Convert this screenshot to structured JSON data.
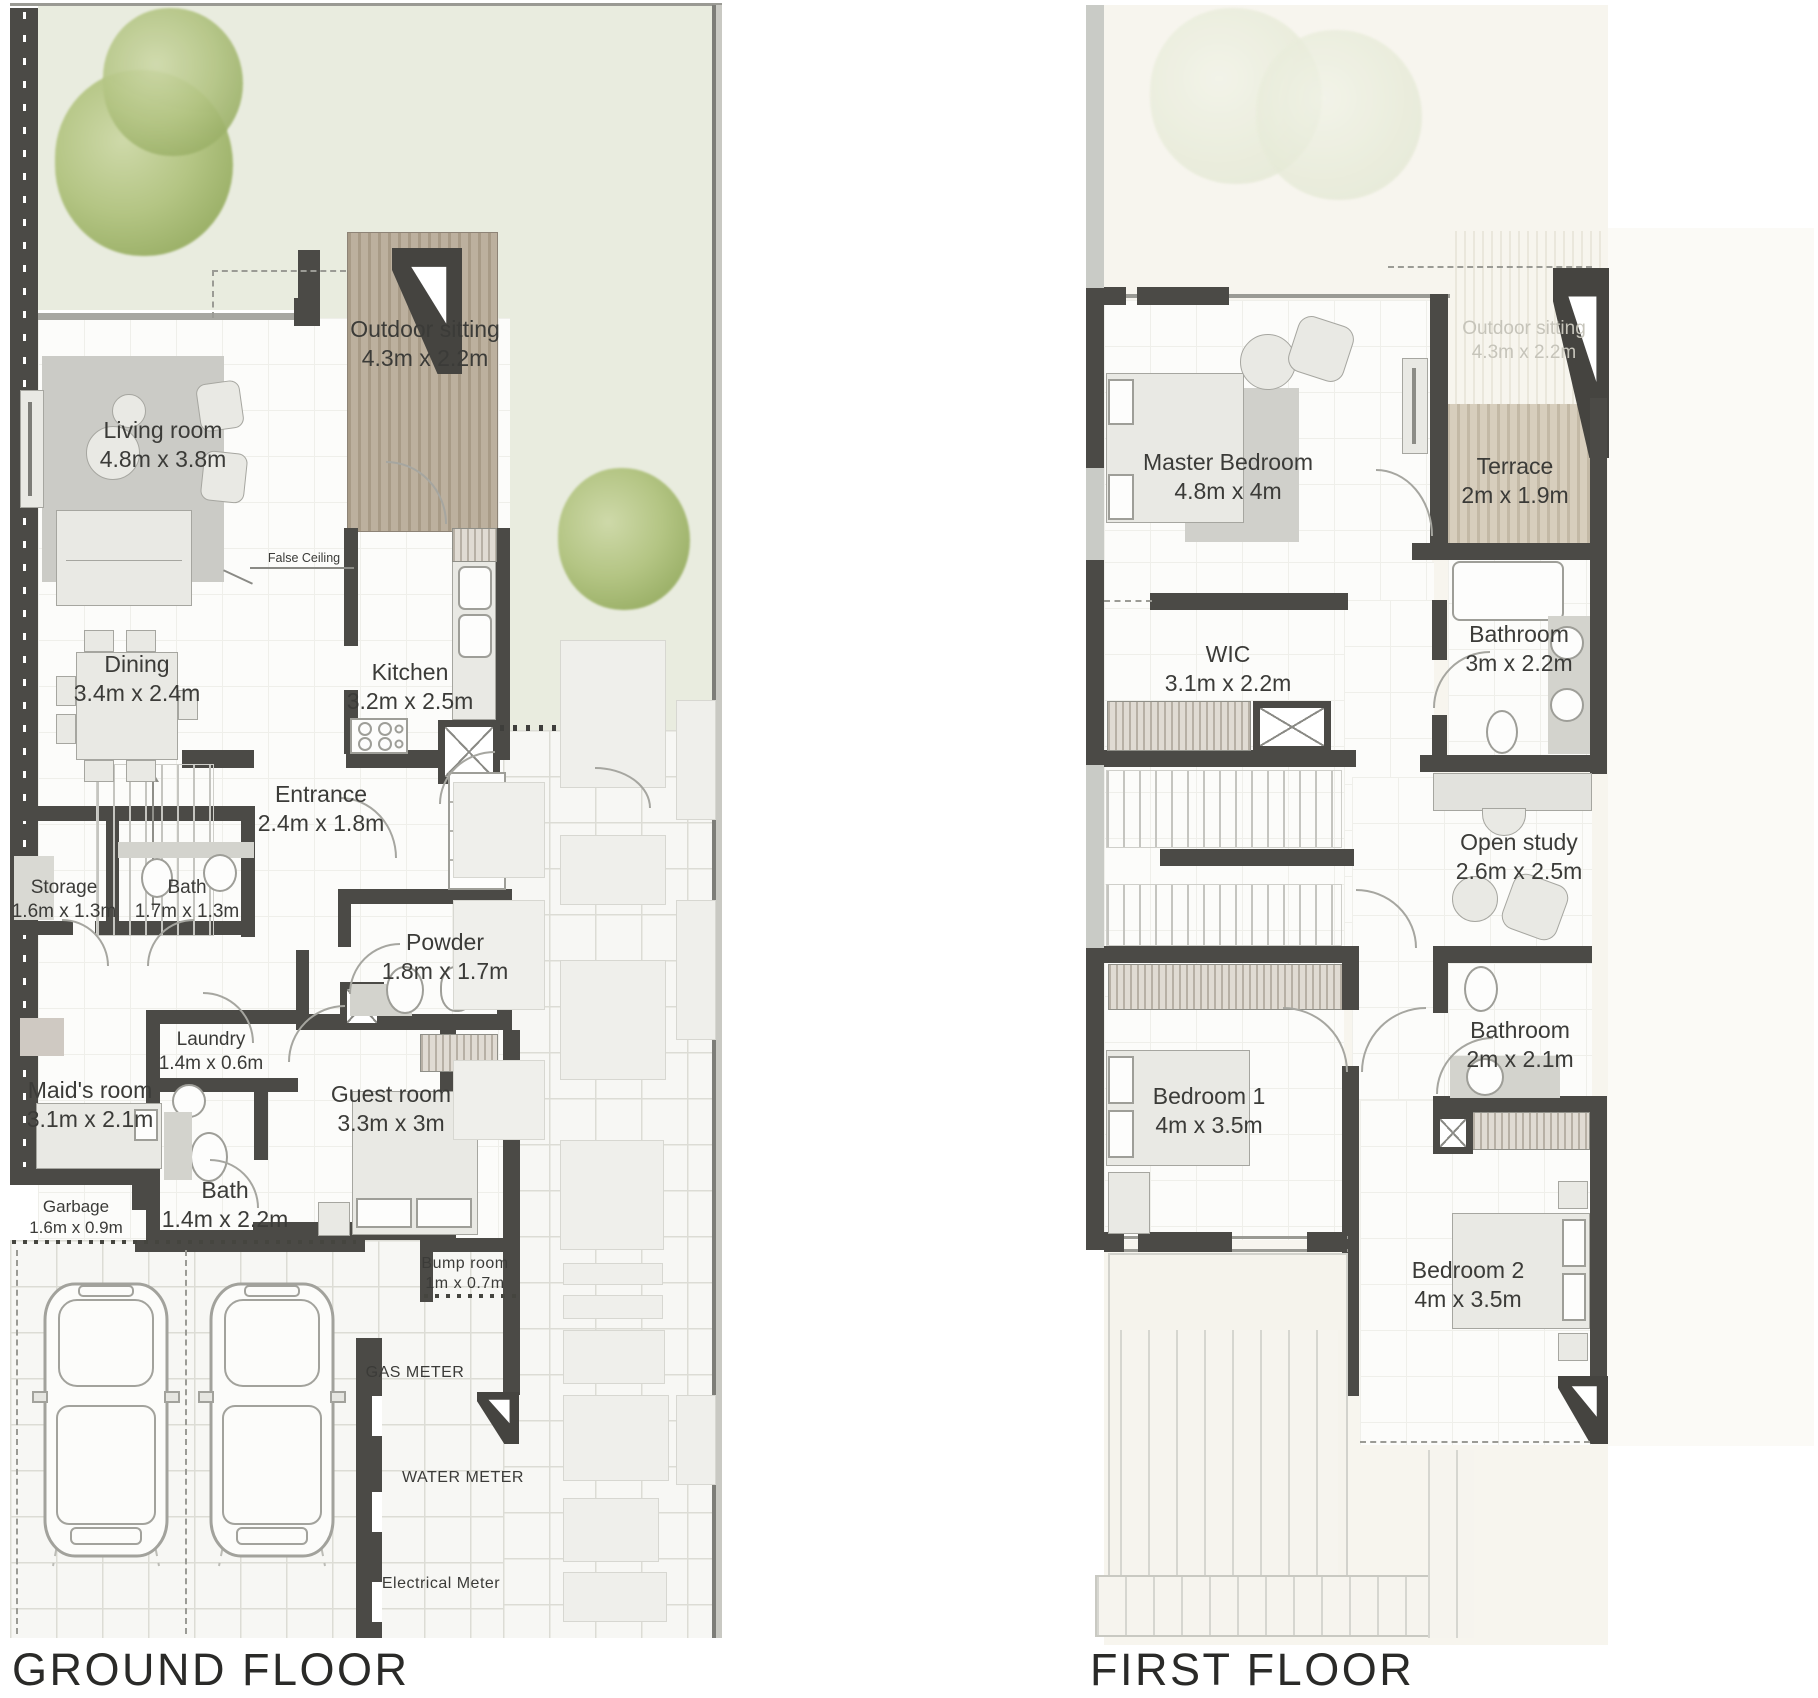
{
  "document": {
    "type": "residential townhouse floor plan sheet"
  },
  "palette": {
    "wall_dark": "#4b4a46",
    "garden_green": "#e9ecdf",
    "tree_green": "#a4b873",
    "deck_brown": "#b0a390",
    "terrace_beige": "#cdc3b1",
    "floor_white": "#fcfcfa",
    "cream": "#f7f5ee",
    "brick_paving": "#f7f7f4",
    "label_text": "#3b3b38",
    "ghost_text": "#c6c4ba"
  },
  "ground_floor": {
    "title": "GROUND FLOOR",
    "rooms": [
      {
        "id": "living",
        "name": "Living room",
        "dims": "4.8m x 3.8m"
      },
      {
        "id": "outdoor",
        "name": "Outdoor sitting",
        "dims": "4.3m x 2.2m"
      },
      {
        "id": "dining",
        "name": "Dining",
        "dims": "3.4m x 2.4m"
      },
      {
        "id": "kitchen",
        "name": "Kitchen",
        "dims": "3.2m x 2.5m"
      },
      {
        "id": "entrance",
        "name": "Entrance",
        "dims": "2.4m x 1.8m"
      },
      {
        "id": "storage",
        "name": "Storage",
        "dims": "1.6m x 1.3m"
      },
      {
        "id": "bath1",
        "name": "Bath",
        "dims": "1.7m x 1.3m"
      },
      {
        "id": "powder",
        "name": "Powder",
        "dims": "1.8m x 1.7m"
      },
      {
        "id": "laundry",
        "name": "Laundry",
        "dims": "1.4m x 0.6m"
      },
      {
        "id": "maids",
        "name": "Maid's room",
        "dims": "3.1m x 2.1m"
      },
      {
        "id": "guest",
        "name": "Guest room",
        "dims": "3.3m x 3m"
      },
      {
        "id": "bath2",
        "name": "Bath",
        "dims": "1.4m x 2.2m"
      },
      {
        "id": "garbage",
        "name": "Garbage",
        "dims": "1.6m x 0.9m"
      },
      {
        "id": "bump",
        "name": "Bump room",
        "dims": "1m x 0.7m"
      }
    ],
    "annotations": {
      "false_ceiling": "False Ceiling",
      "gas_meter": "GAS METER",
      "water_meter": "WATER METER",
      "electrical_meter": "Electrical Meter"
    }
  },
  "first_floor": {
    "title": "FIRST FLOOR",
    "rooms": [
      {
        "id": "master",
        "name": "Master Bedroom",
        "dims": "4.8m x 4m"
      },
      {
        "id": "outdoor_ghost",
        "name": "Outdoor sitting",
        "dims": "4.3m x 2.2m"
      },
      {
        "id": "terrace",
        "name": "Terrace",
        "dims": "2m x 1.9m"
      },
      {
        "id": "bathroom1",
        "name": "Bathroom",
        "dims": "3m x 2.2m"
      },
      {
        "id": "wic",
        "name": "WIC",
        "dims": "3.1m x 2.2m"
      },
      {
        "id": "study",
        "name": "Open study",
        "dims": "2.6m x 2.5m"
      },
      {
        "id": "bathroom2",
        "name": "Bathroom",
        "dims": "2m x 2.1m"
      },
      {
        "id": "bed1",
        "name": "Bedroom 1",
        "dims": "4m x 3.5m"
      },
      {
        "id": "bed2",
        "name": "Bedroom 2",
        "dims": "4m x 3.5m"
      }
    ]
  }
}
